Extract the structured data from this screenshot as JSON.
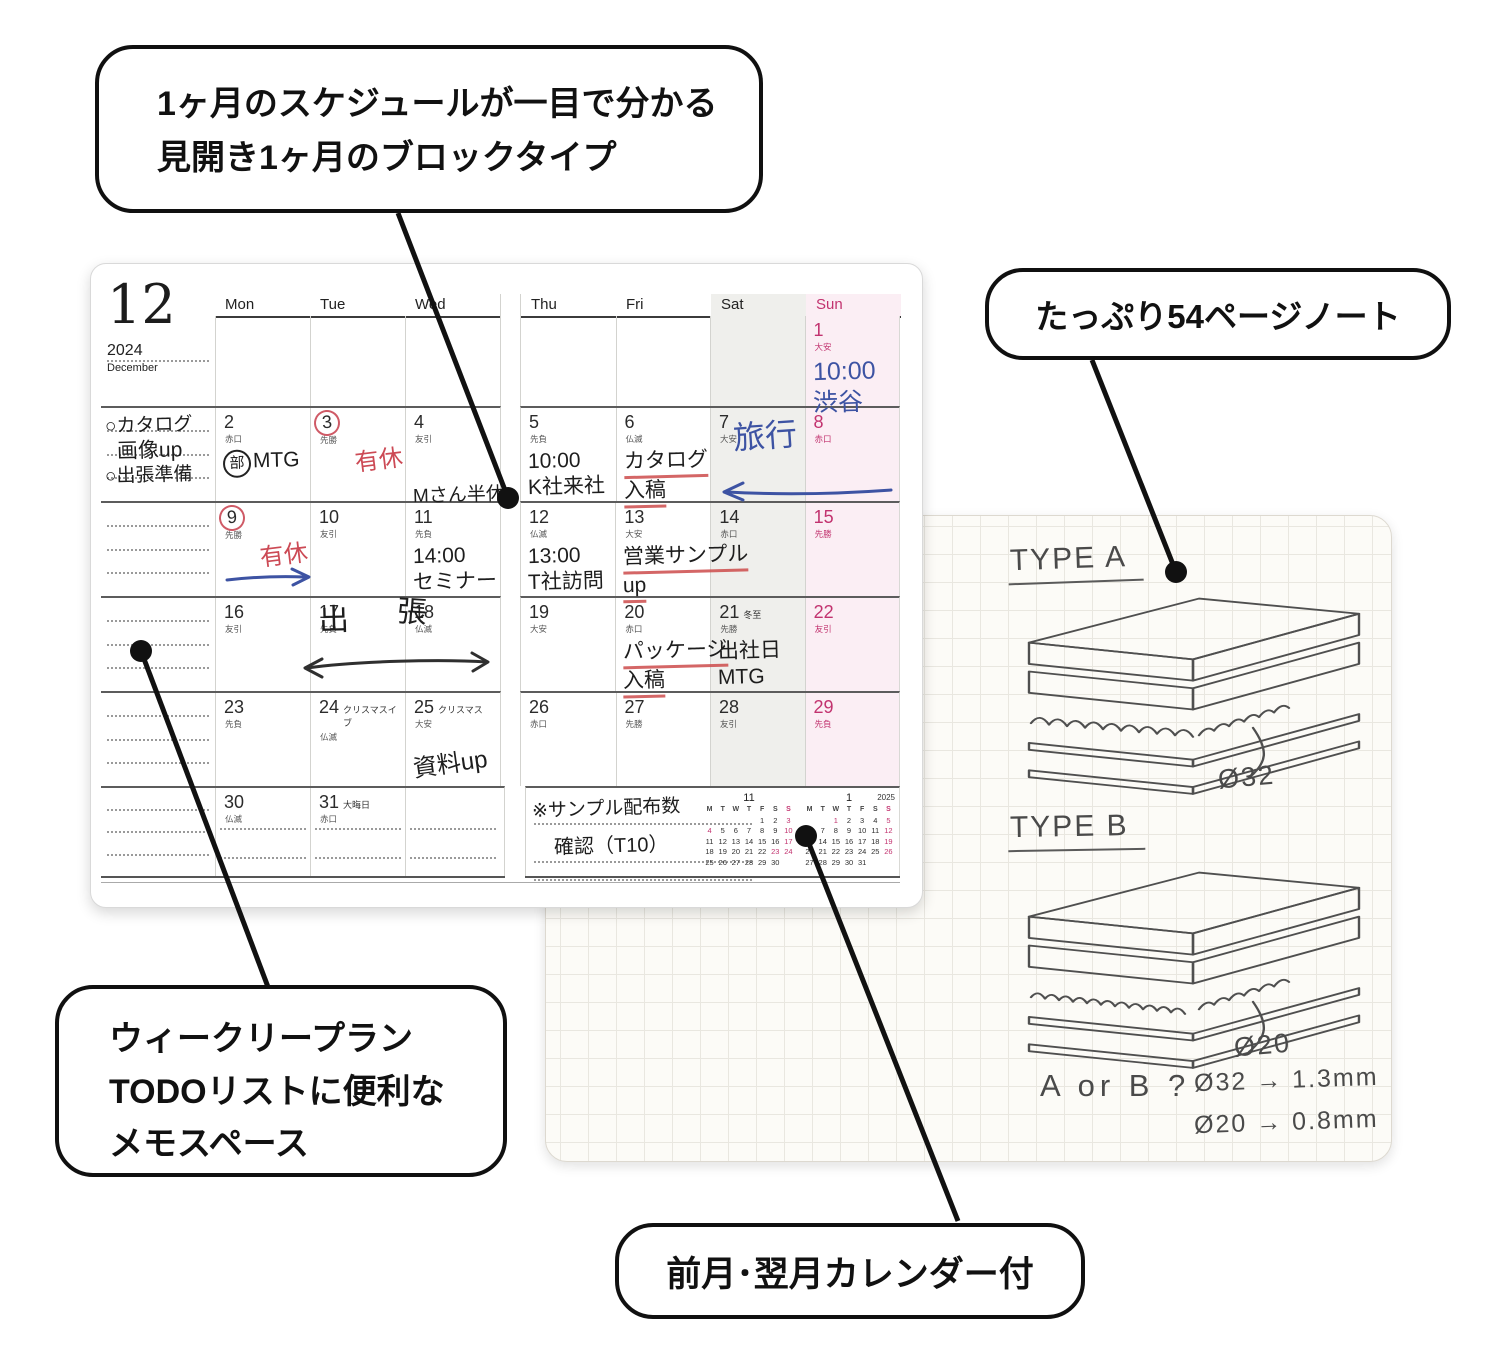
{
  "callouts": {
    "top": {
      "lines": [
        "1ヶ月のスケジュールが一目で分かる",
        "見開き1ヶ月のブロックタイプ"
      ]
    },
    "right": {
      "label": "たっぷり54ページノート"
    },
    "bottom_left": {
      "lines": [
        "ウィークリープラン",
        "TODOリストに便利な",
        "メモスペース"
      ]
    },
    "bottom": {
      "label": "前月･翌月カレンダー付"
    }
  },
  "calendar": {
    "month_number": "12",
    "year": "2024",
    "month_name": "December",
    "weekdays": [
      "Mon",
      "Tue",
      "Wed",
      "Thu",
      "Fri",
      "Sat",
      "Sun"
    ],
    "row_heights": [
      90,
      95,
      95,
      95,
      95,
      90
    ],
    "memo_notes": [
      "○カタログ",
      "画像up",
      "○出張準備"
    ],
    "weeks": [
      [
        null,
        null,
        null,
        null,
        null,
        null,
        {
          "n": "1",
          "r": "大安",
          "hw": [
            {
              "t": "10:00",
              "ink": "b"
            },
            {
              "t": "渋谷",
              "ink": "b"
            }
          ]
        }
      ],
      [
        {
          "n": "2",
          "r": "赤口",
          "hw": [
            {
              "t": "MTG",
              "ink": "k",
              "pre": "部"
            }
          ]
        },
        {
          "n": "3",
          "r": "先勝",
          "circle": 1,
          "hw": [
            {
              "t": "有休",
              "ink": "r",
              "cls": "dayoff"
            }
          ]
        },
        {
          "n": "4",
          "r": "友引",
          "hw": [
            {
              "t": "Mさん半休",
              "ink": "k",
              "cls": "low"
            }
          ]
        },
        {
          "n": "5",
          "r": "先負",
          "hw": [
            {
              "t": "10:00",
              "ink": "k"
            },
            {
              "t": "K社来社",
              "ink": "k"
            }
          ]
        },
        {
          "n": "6",
          "r": "仏滅",
          "hw": [
            {
              "t": "カタログ",
              "ink": "k",
              "u": 1
            },
            {
              "t": "入稿",
              "ink": "k",
              "u": 1
            }
          ]
        },
        {
          "n": "7",
          "r": "大安"
        },
        {
          "n": "8",
          "r": "赤口"
        }
      ],
      [
        {
          "n": "9",
          "r": "先勝",
          "circle": 1,
          "hw": [
            {
              "t": "有休",
              "ink": "r",
              "cls": "dayoff"
            }
          ]
        },
        {
          "n": "10",
          "r": "友引"
        },
        {
          "n": "11",
          "r": "先負",
          "hw": [
            {
              "t": "14:00",
              "ink": "k"
            },
            {
              "t": "セミナー",
              "ink": "k"
            }
          ]
        },
        {
          "n": "12",
          "r": "仏滅",
          "hw": [
            {
              "t": "13:00",
              "ink": "k"
            },
            {
              "t": "T社訪問",
              "ink": "k"
            }
          ]
        },
        {
          "n": "13",
          "r": "大安",
          "hw": [
            {
              "t": "営業サンプル",
              "ink": "k",
              "u": 1
            },
            {
              "t": "up",
              "ink": "k",
              "u": 1
            }
          ]
        },
        {
          "n": "14",
          "r": "赤口"
        },
        {
          "n": "15",
          "r": "先勝"
        }
      ],
      [
        {
          "n": "16",
          "r": "友引"
        },
        {
          "n": "17",
          "r": "先負"
        },
        {
          "n": "18",
          "r": "仏滅"
        },
        {
          "n": "19",
          "r": "大安"
        },
        {
          "n": "20",
          "r": "赤口",
          "hw": [
            {
              "t": "パッケージ",
              "ink": "k",
              "u": 1
            },
            {
              "t": "入稿",
              "ink": "k",
              "u": 1
            }
          ]
        },
        {
          "n": "21",
          "r": "先勝",
          "note": "冬至",
          "hw": [
            {
              "t": "出社日",
              "ink": "k"
            },
            {
              "t": "MTG",
              "ink": "k"
            }
          ]
        },
        {
          "n": "22",
          "r": "友引"
        }
      ],
      [
        {
          "n": "23",
          "r": "先負"
        },
        {
          "n": "24",
          "r": "仏滅",
          "note": "クリスマスイブ"
        },
        {
          "n": "25",
          "r": "大安",
          "note": "クリスマス",
          "hw": [
            {
              "t": "資料up",
              "ink": "k",
              "cls": "tilt"
            }
          ]
        },
        {
          "n": "26",
          "r": "赤口"
        },
        {
          "n": "27",
          "r": "先勝"
        },
        {
          "n": "28",
          "r": "友引"
        },
        {
          "n": "29",
          "r": "先負"
        }
      ],
      [
        {
          "n": "30",
          "r": "仏滅"
        },
        {
          "n": "31",
          "r": "赤口",
          "note": "大晦日"
        },
        null
      ]
    ],
    "annotations": {
      "trip": "旅行",
      "biz1": "出",
      "biz2": "張"
    },
    "footer_notes": [
      "※サンプル配布数",
      "確認（T10）"
    ],
    "mini_calendars": [
      {
        "title": "11",
        "year": "",
        "head": [
          "M",
          "T",
          "W",
          "T",
          "F",
          "S",
          "S"
        ],
        "blanks": 4,
        "last": 30,
        "pink": [
          3,
          4,
          10,
          17,
          23,
          24
        ]
      },
      {
        "title": "1",
        "year": "2025",
        "head": [
          "M",
          "T",
          "W",
          "T",
          "F",
          "S",
          "S"
        ],
        "blanks": 2,
        "last": 31,
        "pink": [
          1,
          5,
          12,
          13,
          19,
          26
        ]
      }
    ]
  },
  "notebook": {
    "type_a": "TYPE A",
    "type_b": "TYPE B",
    "dia_a": "Ø32",
    "dia_b": "Ø20",
    "question": "A or B ?",
    "note_1": "Ø32 → 1.3mm",
    "note_2": "Ø20 → 0.8mm"
  },
  "colors": {
    "accent_pink": "#c2336f",
    "saturday_bg": "#efefec",
    "sunday_bg": "#fbeef4",
    "ink_blue": "#3d53a3",
    "ink_red": "#cc4a55",
    "ink_black": "#1d1d1d"
  }
}
